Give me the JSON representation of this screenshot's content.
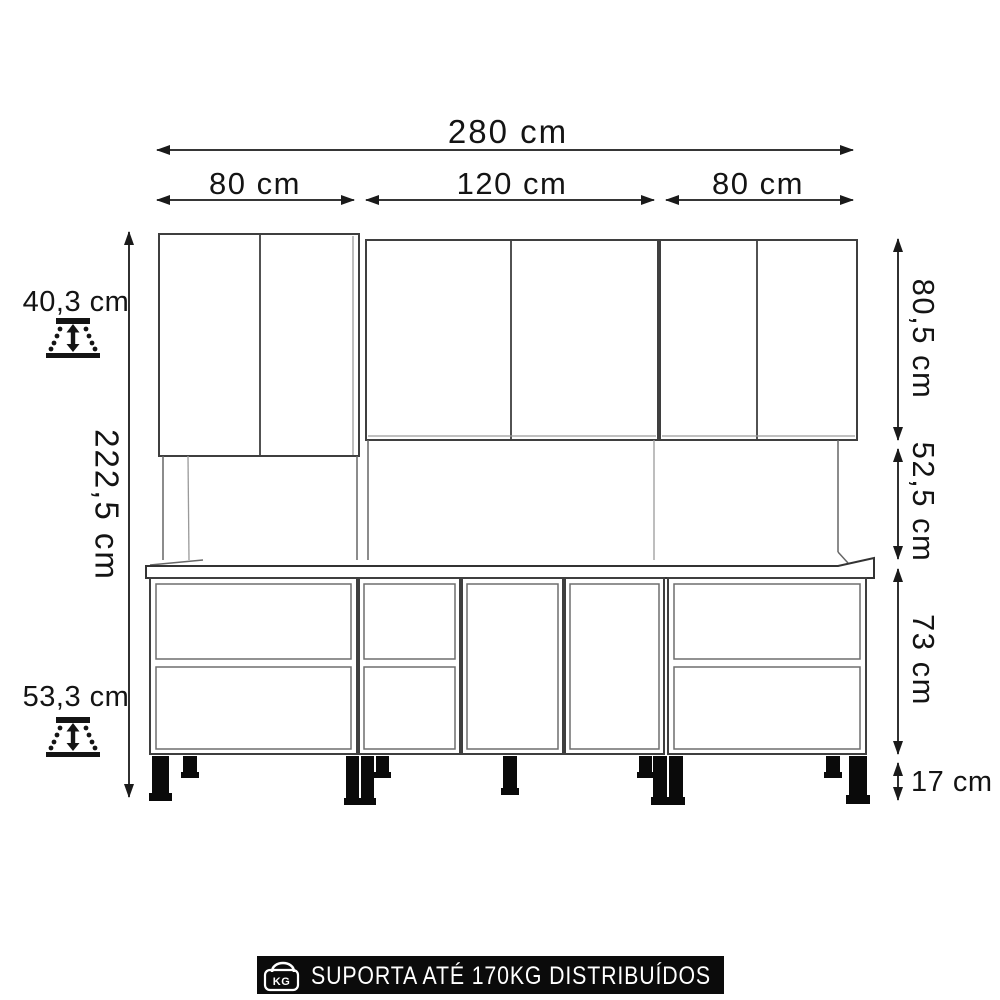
{
  "colors": {
    "background": "#ffffff",
    "dimension_lines": "#1a1a1a",
    "cabinet_outline": "#3f3f3f",
    "cabinet_inner": "#6e6e6e",
    "legs": "#0a0a0a",
    "banner_background": "#0b0b0b",
    "banner_text": "#ffffff"
  },
  "dimensions": {
    "horizontal": {
      "total": "280 cm",
      "left_module": "80 cm",
      "center_module": "120 cm",
      "right_module": "80 cm"
    },
    "vertical": {
      "total": "222,5 cm",
      "upper_cabinets": "80,5 cm",
      "backsplash_gap": "52,5 cm",
      "base_cabinets": "73 cm",
      "legs": "17 cm"
    },
    "depth": {
      "upper_cabinets": "40,3 cm",
      "base_cabinets": "53,3 cm"
    }
  },
  "banner": {
    "label": "SUPORTA ATÉ 170KG DISTRIBUÍDOS",
    "kg_icon_text": "KG"
  }
}
